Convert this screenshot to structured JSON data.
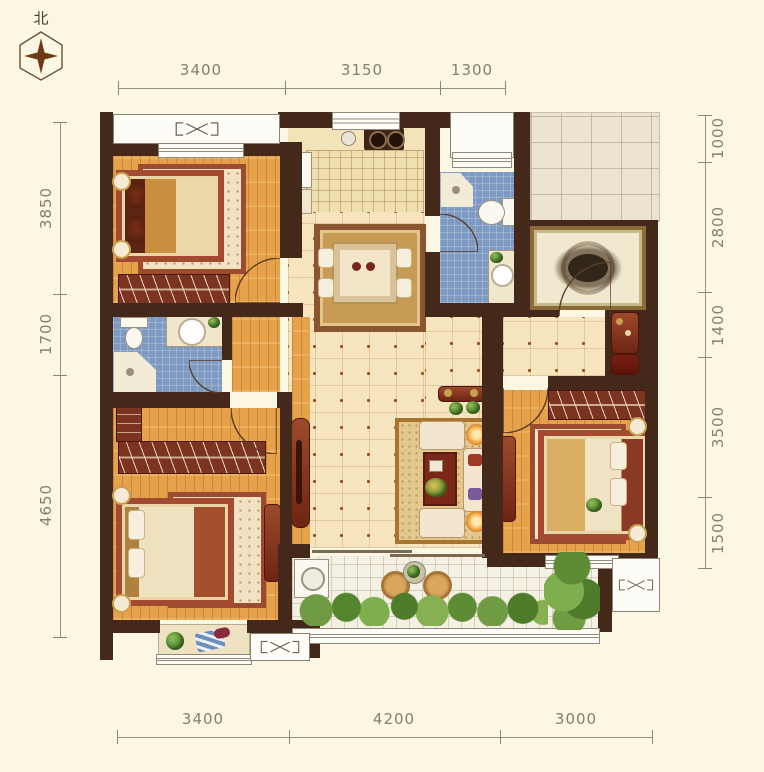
{
  "compass": {
    "label": "北"
  },
  "dimensions": {
    "top": [
      "3400",
      "3150",
      "1300"
    ],
    "bottom": [
      "3400",
      "4200",
      "3000"
    ],
    "left": [
      "3850",
      "1700",
      "4650"
    ],
    "right": [
      "1000",
      "2800",
      "1400",
      "3500",
      "1500"
    ]
  },
  "colors": {
    "background": "#fcf7e3",
    "wall": "#44281a",
    "wood_floor": "#e5a24b",
    "hall_tile": "#f7e5bf",
    "bath_tile": "#7e9ac2",
    "balcony_tile": "#f4f0e3",
    "corridor_tile": "#ece4d1",
    "furniture_red": "#8a3a22",
    "rug_gold": "#c89b54",
    "dimension_text": "#85806d"
  }
}
